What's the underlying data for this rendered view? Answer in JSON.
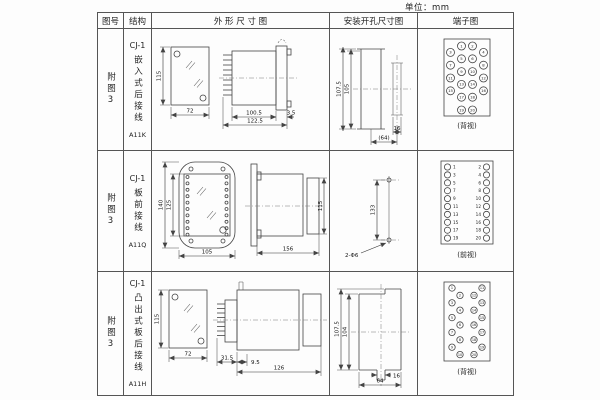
{
  "units_label": "单位：mm",
  "headers": {
    "fig_no": "图号",
    "structure": "结构",
    "outline": "外 形 尺 寸 图",
    "mounting": "安装开孔尺寸图",
    "terminal": "端子图"
  },
  "rows": [
    {
      "fig_no": "附图3",
      "model": "CJ-1",
      "structure_desc": "嵌入式后接线",
      "code": "A11K",
      "outline": {
        "front_h": "115",
        "front_w": "72",
        "depth_case": "100.5",
        "depth_total": "122.5",
        "flange": "3.5"
      },
      "mounting": {
        "v_outer": "107.5",
        "v_inner": "105",
        "w_slot": "16",
        "w_overall": "(64)"
      },
      "terminal_label": "(背视)",
      "terminal_numbers": [
        "1",
        "2",
        "3",
        "4",
        "5",
        "6",
        "7",
        "8",
        "9",
        "10",
        "11",
        "12",
        "13",
        "14",
        "15",
        "16",
        "17",
        "18",
        "19",
        "20"
      ]
    },
    {
      "fig_no": "附图3",
      "model": "CJ-1",
      "structure_desc": "板前接线",
      "code": "A11Q",
      "outline": {
        "front_h_outer": "140",
        "front_h_inner": "125",
        "front_w": "105",
        "depth": "156",
        "side_h": "115"
      },
      "mounting": {
        "v": "133",
        "hole_label": "2-Φ6"
      },
      "terminal_label": "(前视)",
      "terminal_numbers_left": [
        "1",
        "3",
        "5",
        "7",
        "9",
        "11",
        "13",
        "15",
        "17",
        "19"
      ],
      "terminal_numbers_right": [
        "2",
        "4",
        "6",
        "8",
        "10",
        "12",
        "14",
        "16",
        "18",
        "20"
      ]
    },
    {
      "fig_no": "附图3",
      "model": "CJ-1",
      "structure_desc": "凸出式板后接线",
      "code": "A11H",
      "outline": {
        "front_h": "115",
        "front_w": "72",
        "d_base": "31.5",
        "d_gap": "9.5",
        "depth_total": "126"
      },
      "mounting": {
        "v_outer": "107.5",
        "v_inner": "104",
        "w_slot": "16",
        "w_overall": "64"
      },
      "terminal_label": "(背视)",
      "terminal_numbers": [
        "1",
        "2",
        "3",
        "4",
        "5",
        "6",
        "7",
        "8",
        "9",
        "10",
        "11",
        "12",
        "13",
        "14",
        "15",
        "16",
        "17",
        "18",
        "19",
        "20"
      ]
    }
  ]
}
